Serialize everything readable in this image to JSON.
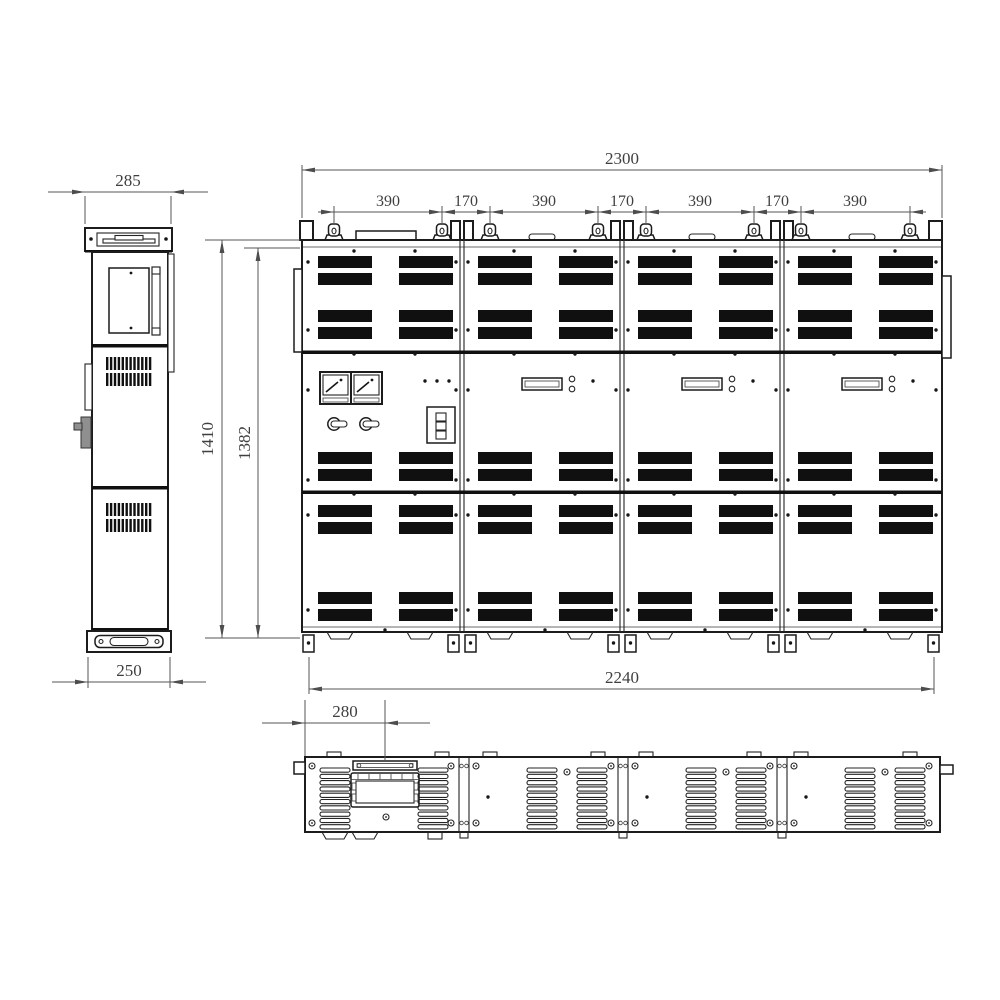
{
  "drawing": {
    "background_color": "#ffffff",
    "line_color": "#1c1c1c",
    "dimension_color": "#4d4d4d",
    "dimensions_mm": {
      "side_top_width": "285",
      "side_base_width": "250",
      "overall_height": "1410",
      "door_height": "1382",
      "front_overall_width": "2300",
      "base_width": "2240",
      "top_chain": [
        "390",
        "170",
        "390",
        "170",
        "390",
        "170",
        "390"
      ],
      "top_view_offset": "280"
    }
  }
}
